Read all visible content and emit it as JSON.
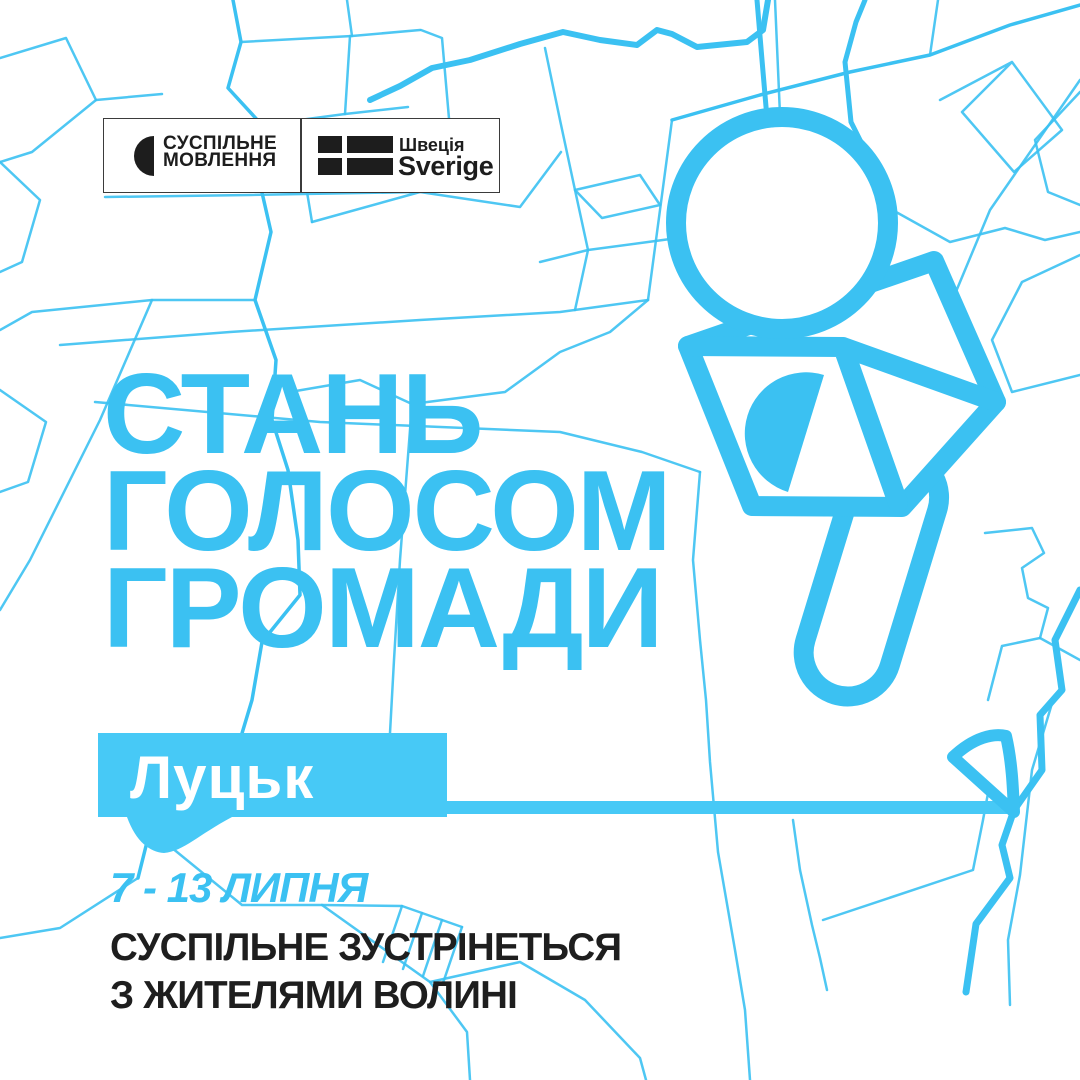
{
  "colors": {
    "accent": "#3BC1F2",
    "banner": "#47C9F6",
    "ink": "#1E1E1E",
    "logoink": "#1D1D1D",
    "paper": "#FFFFFF"
  },
  "logo_bar": {
    "suspilne": {
      "line1": "СУСПІЛЬНЕ",
      "line2": "МОВЛЕННЯ"
    },
    "sweden": {
      "name_uk": "Швеція",
      "name_sv": "Sverige"
    }
  },
  "headline": {
    "line1": "СТАНЬ",
    "line2": "ГОЛОСОМ",
    "line3": "ГРОМАДИ"
  },
  "city_banner": {
    "city": "Луцьк"
  },
  "schedule": {
    "dates": "7 - 13 ЛИПНЯ"
  },
  "description": {
    "line1": "СУСПІЛЬНЕ ЗУСТРІНЕТЬСЯ",
    "line2": "З ЖИТЕЛЯМИ ВОЛИНІ"
  }
}
